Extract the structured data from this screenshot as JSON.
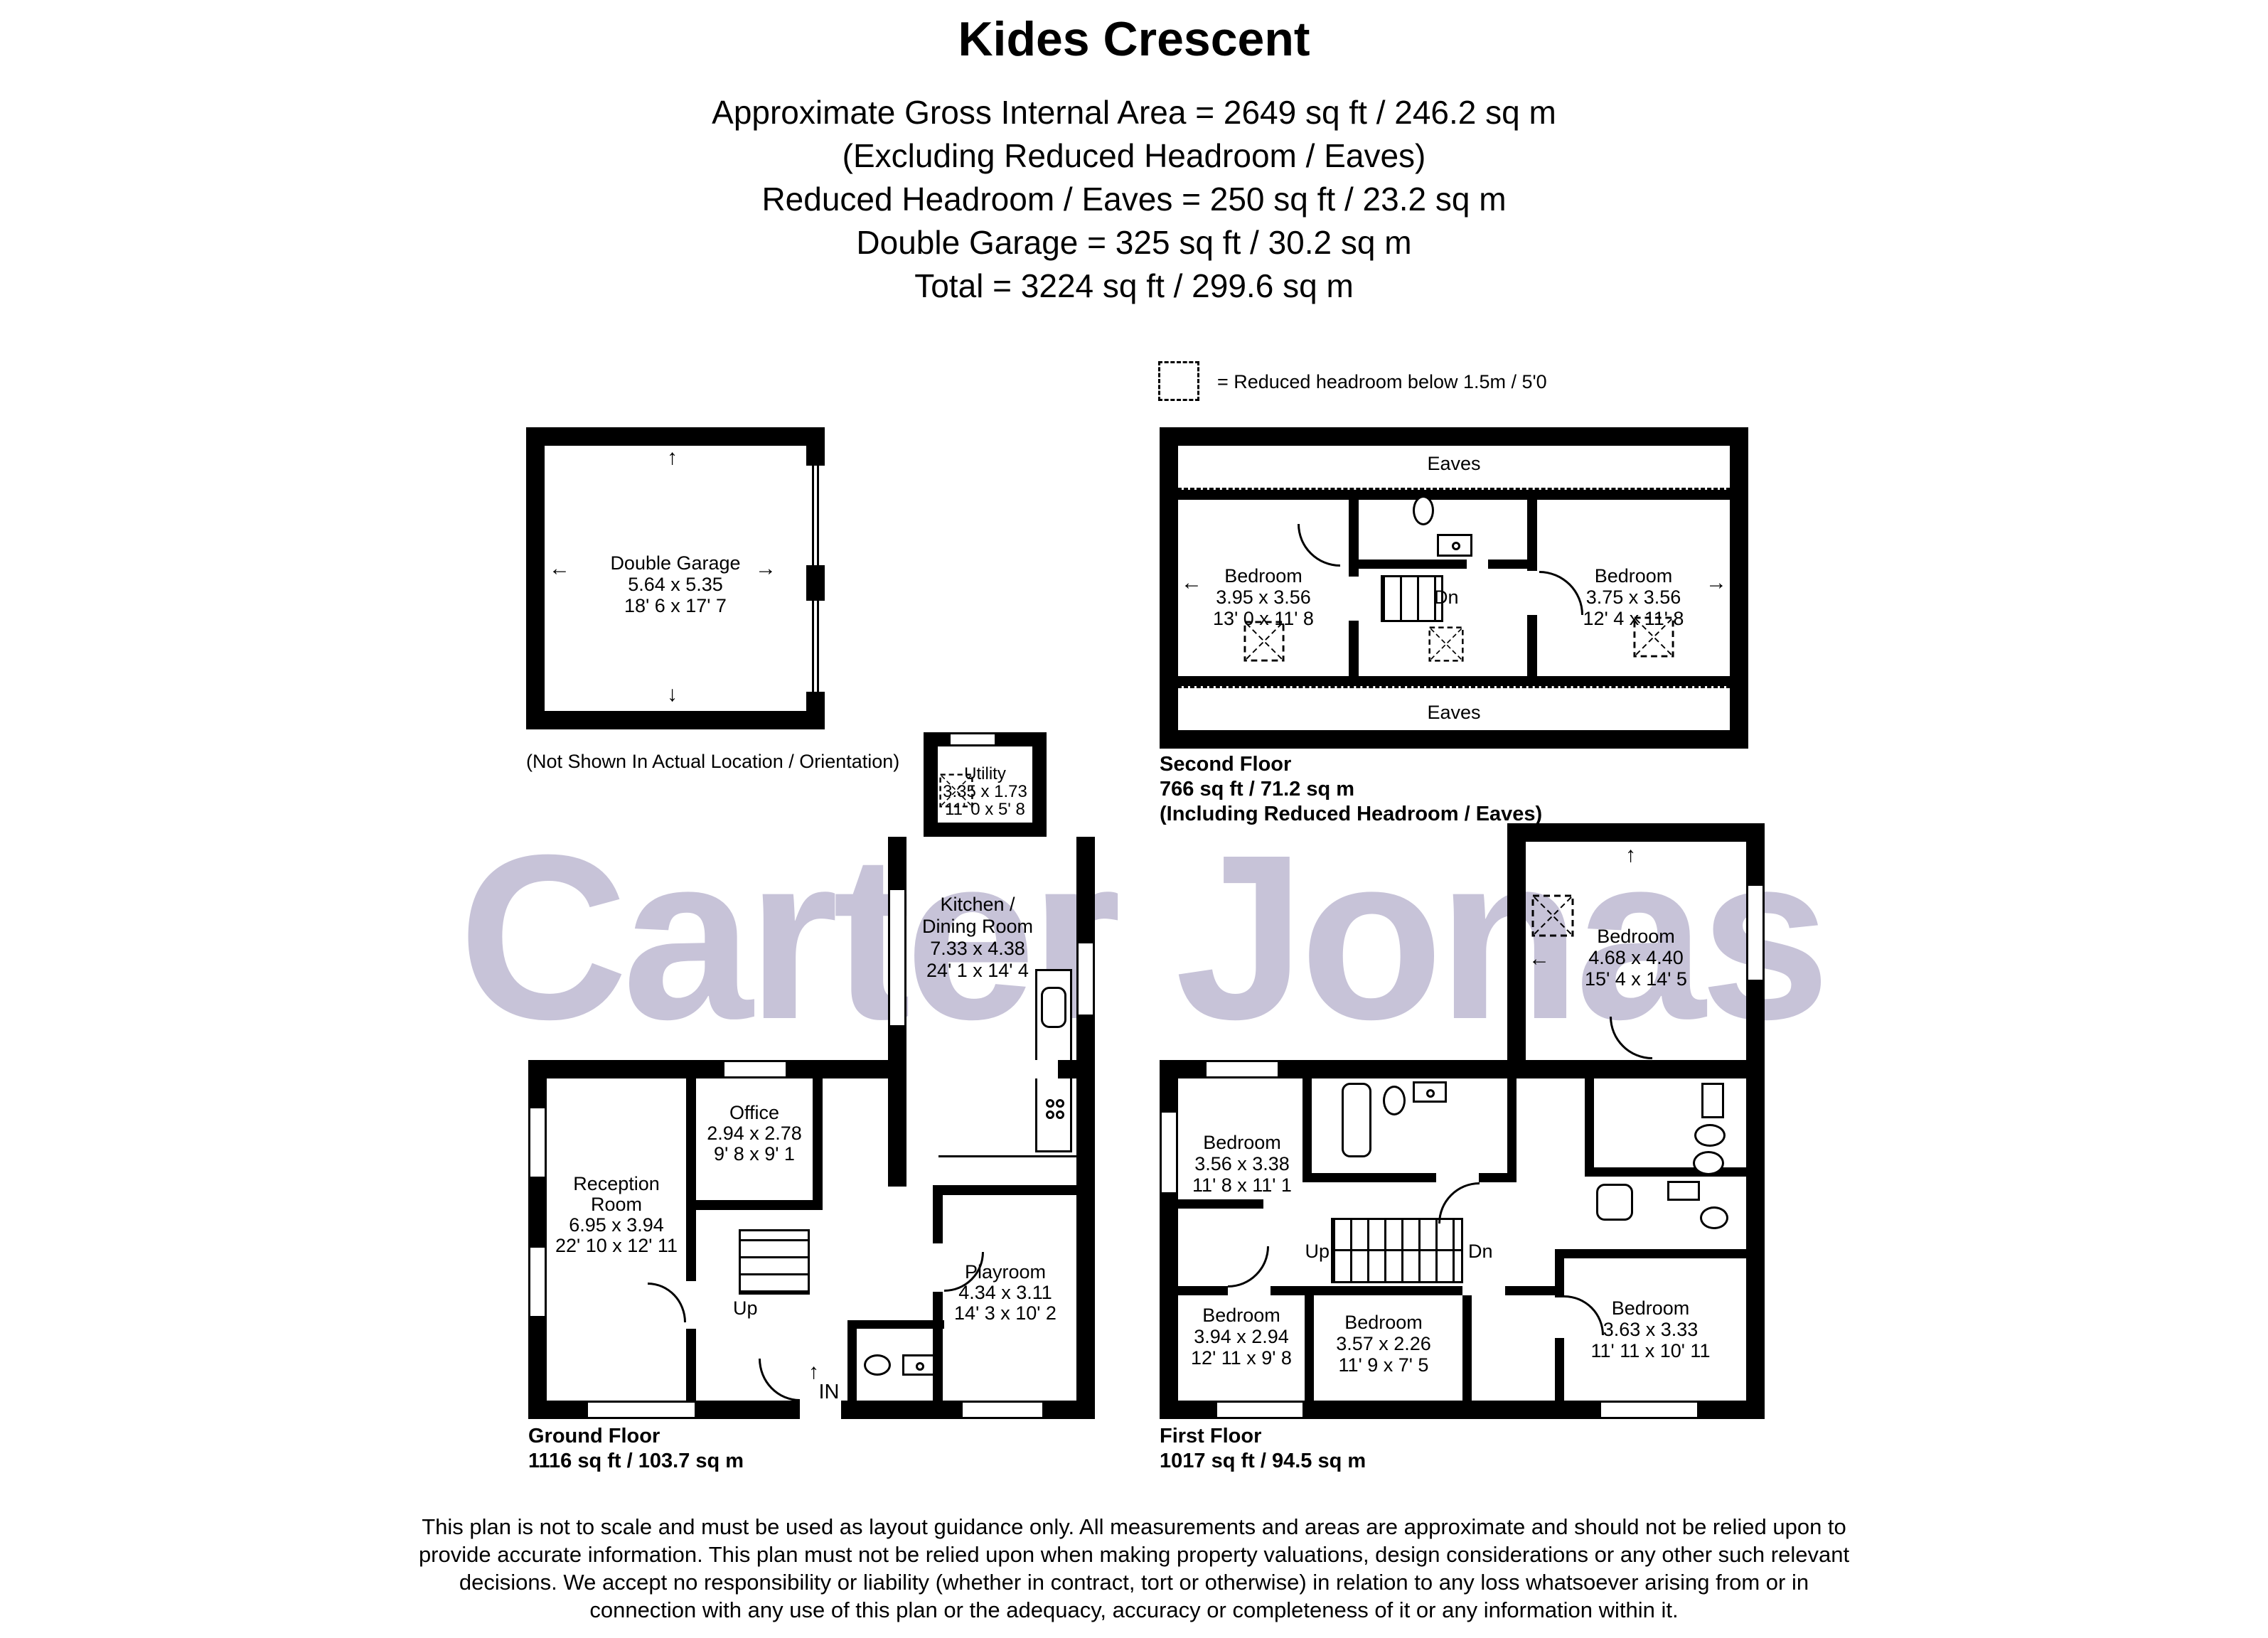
{
  "header": {
    "title": "Kides Crescent",
    "line1": "Approximate Gross Internal Area = 2649 sq ft / 246.2 sq m",
    "line2": "(Excluding Reduced Headroom / Eaves)",
    "line3": "Reduced Headroom / Eaves = 250 sq ft / 23.2 sq m",
    "line4": "Double Garage = 325 sq ft / 30.2 sq m",
    "line5": "Total = 3224 sq ft / 299.6 sq m"
  },
  "legend": {
    "label": "= Reduced headroom below 1.5m / 5'0"
  },
  "garage": {
    "name": "Double Garage",
    "metric": "5.64 x 5.35",
    "imperial": "18' 6 x 17' 7",
    "note": "(Not Shown In Actual Location / Orientation)"
  },
  "second_floor": {
    "eaves_top": "Eaves",
    "eaves_bottom": "Eaves",
    "bedroom_left": {
      "name": "Bedroom",
      "metric": "3.95 x 3.56",
      "imperial": "13' 0 x 11' 8"
    },
    "bedroom_right": {
      "name": "Bedroom",
      "metric": "3.75 x 3.56",
      "imperial": "12' 4 x 11' 8"
    },
    "stairs_label": "Dn",
    "caption1": "Second Floor",
    "caption2": "766 sq ft / 71.2 sq m",
    "caption3": "(Including Reduced Headroom / Eaves)"
  },
  "ground_floor": {
    "utility": {
      "name": "Utility",
      "metric": "3.35 x 1.73",
      "imperial": "11' 0 x 5' 8"
    },
    "kitchen": {
      "name1": "Kitchen /",
      "name2": "Dining Room",
      "metric": "7.33 x 4.38",
      "imperial": "24' 1 x 14' 4"
    },
    "office": {
      "name": "Office",
      "metric": "2.94 x 2.78",
      "imperial": "9' 8 x 9' 1"
    },
    "reception": {
      "name1": "Reception",
      "name2": "Room",
      "metric": "6.95 x 3.94",
      "imperial": "22' 10 x 12' 11"
    },
    "playroom": {
      "name": "Playroom",
      "metric": "4.34 x 3.11",
      "imperial": "14' 3 x 10' 2"
    },
    "stairs_label": "Up",
    "entrance_label": "IN",
    "caption1": "Ground Floor",
    "caption2": "1116 sq ft / 103.7 sq m"
  },
  "first_floor": {
    "bedroom_topleft": {
      "name": "Bedroom",
      "metric": "3.56 x 3.38",
      "imperial": "11' 8 x 11' 1"
    },
    "bedroom_topright": {
      "name": "Bedroom",
      "metric": "4.68 x 4.40",
      "imperial": "15' 4 x 14' 5"
    },
    "bedroom_bottomleft": {
      "name": "Bedroom",
      "metric": "3.94 x 2.94",
      "imperial": "12' 11 x 9' 8"
    },
    "bedroom_bottommiddle": {
      "name": "Bedroom",
      "metric": "3.57 x 2.26",
      "imperial": "11' 9 x 7' 5"
    },
    "bedroom_bottomright": {
      "name": "Bedroom",
      "metric": "3.63 x 3.33",
      "imperial": "11' 11 x 10' 11"
    },
    "stairs_up": "Up",
    "stairs_dn": "Dn",
    "caption1": "First Floor",
    "caption2": "1017 sq ft / 94.5 sq m"
  },
  "watermark": "Carter Jonas",
  "disclaimer": {
    "line1": "This plan is not to scale and must be used as layout guidance only. All measurements and areas are approximate and should not be relied upon to",
    "line2": "provide accurate information. This plan must not be relied upon when making property valuations, design considerations or any other such relevant",
    "line3": "decisions. We accept no responsibility or liability (whether in contract, tort or otherwise) in relation to any loss whatsoever arising from or in",
    "line4": "connection with any use of this plan or the adequacy, accuracy or completeness of it or any information within it."
  },
  "icons": {
    "up": "↑",
    "down": "↓",
    "left": "←",
    "right": "→"
  },
  "colors": {
    "wall": "#000000",
    "watermark": "#c7c3d8",
    "background": "#ffffff"
  }
}
